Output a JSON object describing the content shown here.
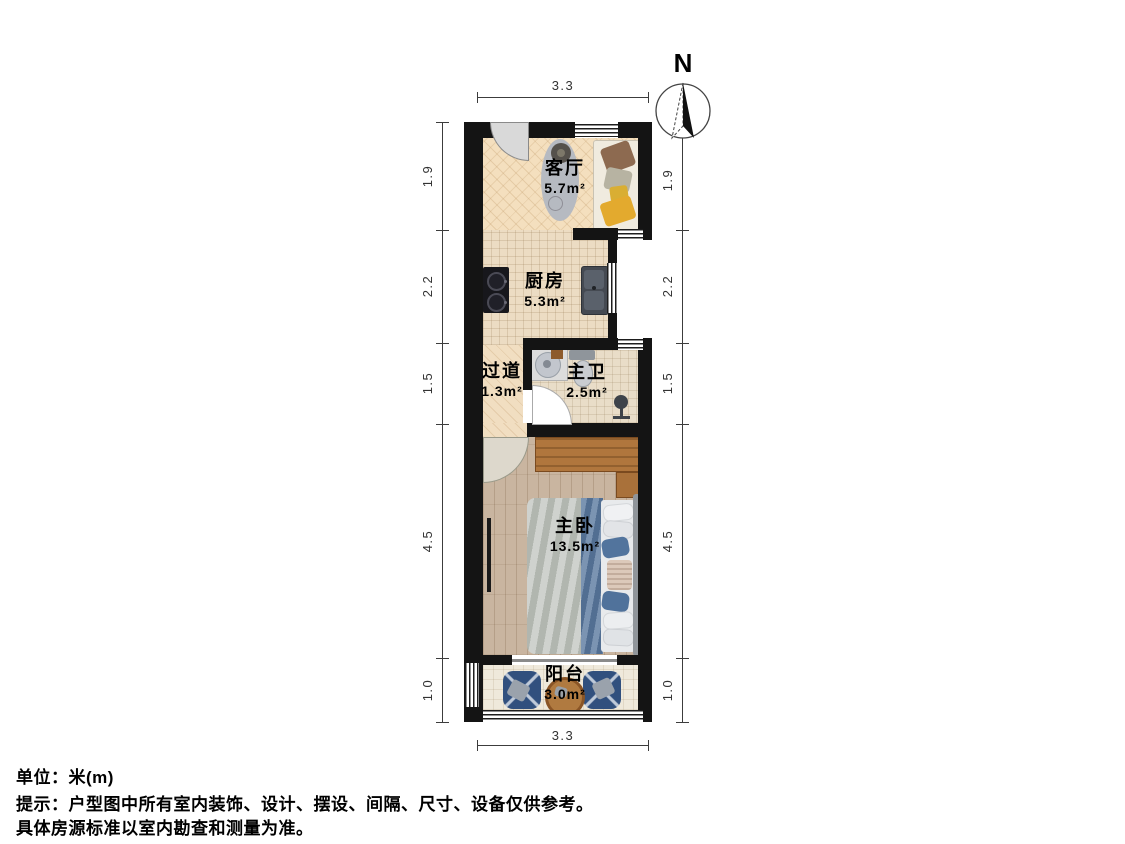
{
  "rooms": [
    {
      "id": "living",
      "name": "客厅",
      "area": "5.7m²"
    },
    {
      "id": "kitchen",
      "name": "厨房",
      "area": "5.3m²"
    },
    {
      "id": "hallway",
      "name": "过道",
      "area": "1.3m²"
    },
    {
      "id": "bathroom",
      "name": "主卫",
      "area": "2.5m²"
    },
    {
      "id": "bedroom",
      "name": "主卧",
      "area": "13.5m²"
    },
    {
      "id": "balcony",
      "name": "阳台",
      "area": "3.0m²"
    }
  ],
  "dimensions": {
    "top": "3.3",
    "bottom": "3.3",
    "left": [
      "1.9",
      "2.2",
      "1.5",
      "4.5",
      "1.0"
    ],
    "right": [
      "1.9",
      "2.2",
      "1.5",
      "4.5",
      "1.0"
    ]
  },
  "compass": {
    "label": "N"
  },
  "footer": {
    "unit": "单位：米(m)",
    "hint1": "提示：户型图中所有室内装饰、设计、摆设、间隔、尺寸、设备仅供参考。",
    "hint2": "具体房源标准以室内勘查和测量为准。"
  },
  "colors": {
    "wall": "#141414",
    "living_floor": "#f4dfbe",
    "kitchen_floor": "#ecdcc3",
    "bedroom_floor": "#c9b5a0",
    "balcony_chair": "#31507e",
    "wood_furniture": "#b0763d",
    "bed_blue": "#5e7ca1",
    "bed_gray": "#bdc1bb",
    "sofa": "#f0ebdf",
    "accent_yellow": "#e3aa2e"
  }
}
